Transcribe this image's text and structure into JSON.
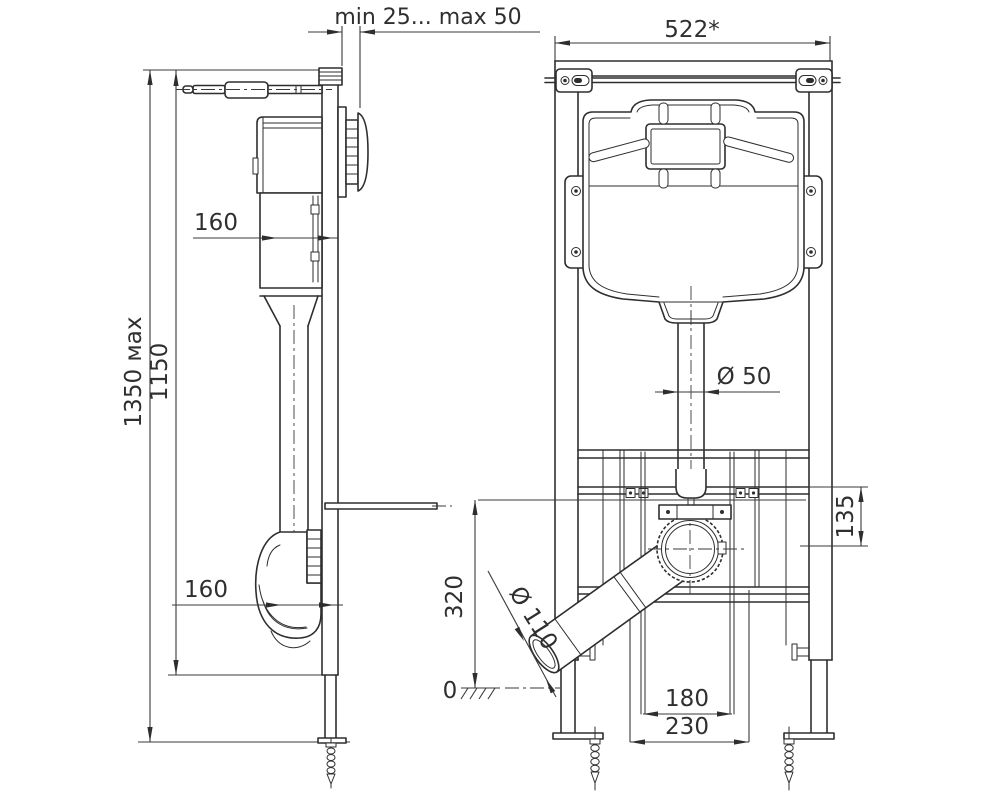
{
  "drawing": {
    "side_view": {
      "dim_wall_offset": "min 25... max 50",
      "dim_height_max": "1350 мах",
      "dim_height_frame": "1150",
      "dim_cistern_depth_top": "160",
      "dim_cistern_depth_bottom": "160"
    },
    "front_view": {
      "dim_frame_width": "522*",
      "dim_flush_pipe_diameter": "Ø 50",
      "dim_outlet_drop": "135",
      "dim_outlet_height": "320",
      "dim_floor_level": "0",
      "dim_fixing_studs_spacing": "180",
      "dim_outlet_offset_width": "230",
      "dim_outlet_pipe_diameter": "Ø 110"
    },
    "colors": {
      "line": "#2e2e2e",
      "background": "#ffffff"
    }
  }
}
